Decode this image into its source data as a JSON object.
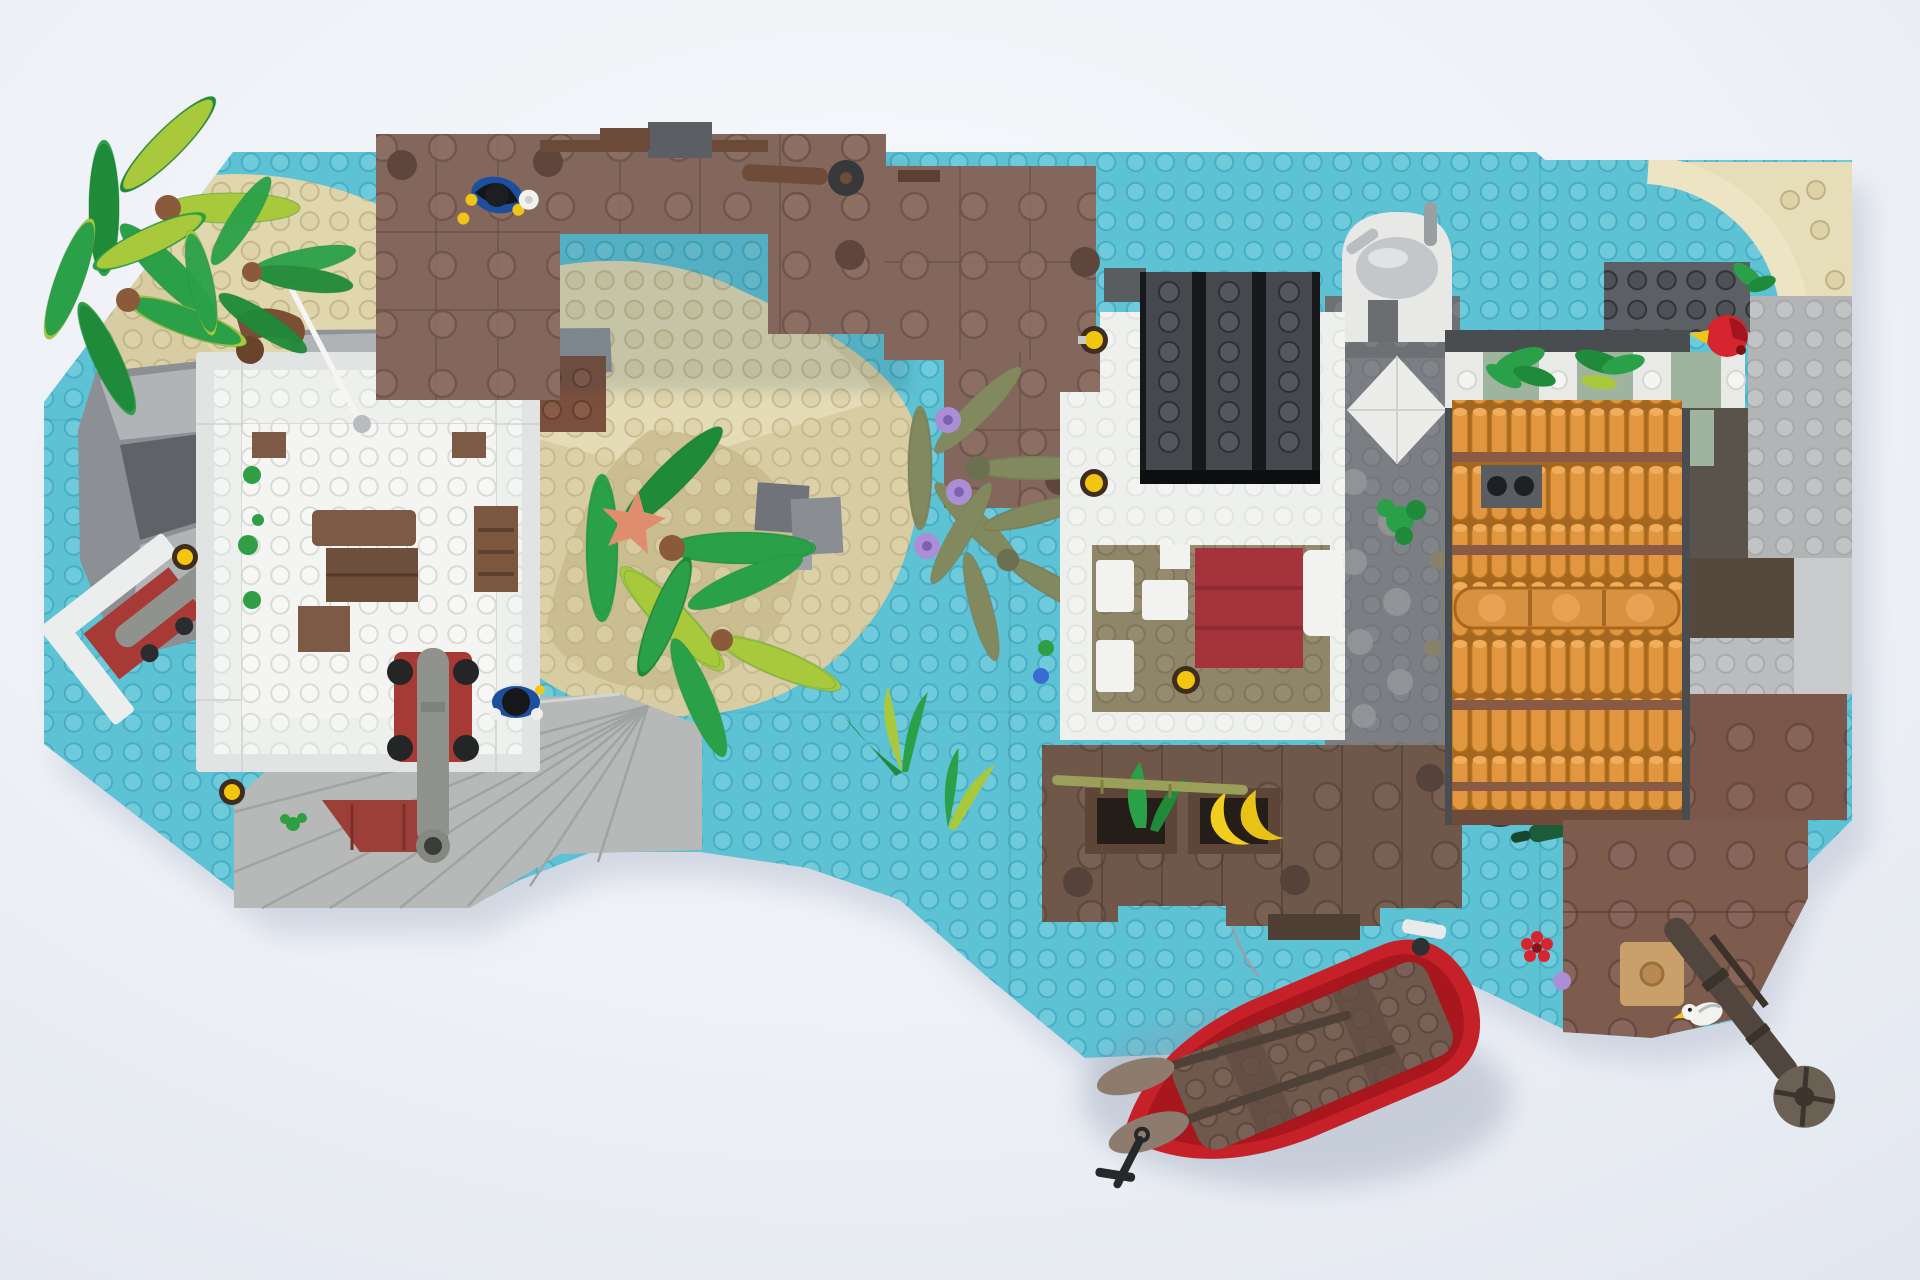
{
  "scene": {
    "title": "Top-down render of a LEGO pirate island harbor diorama",
    "type": "3D LEGO model render, no UI text visible",
    "view": "top-down aerial",
    "background": "soft white studio backdrop",
    "objects": [
      {
        "name": "baseplate",
        "description": "large medium-azure water baseplate with studs, irregular octagonal outline"
      },
      {
        "name": "sand-island-left",
        "description": "tan sand island at top-left with two palm trees"
      },
      {
        "name": "palm-trees-left",
        "description": "two palm canopies of bright green and lime fronds with brown trunk pieces"
      },
      {
        "name": "fort",
        "description": "square white-walled fort with open courtyard, brown furniture, ladder, cannon on red carriage pointing south, leaning white flag mast"
      },
      {
        "name": "fort-minifig",
        "description": "minifigure with black hair and blue jacket inside fort near cannon"
      },
      {
        "name": "gun-emplacement",
        "description": "small angled gun platform with white walls, dark-red base and gray cannon at island west shore"
      },
      {
        "name": "stone-stairs",
        "description": "fanned light-gray stair slabs descending at the island south edge"
      },
      {
        "name": "sand-mound-center",
        "description": "large round sand mound with gray rock bricks and a salmon starfish"
      },
      {
        "name": "north-dock",
        "description": "reddish-brown plank dock complex along the top edge with mounted cannon and a soldier minifig in blue coat, black tricorn, holding a white mug"
      },
      {
        "name": "center-palm",
        "description": "bright green and lime palm canopy south of the sand mound"
      },
      {
        "name": "olive-palm",
        "description": "fallen olive-green palm fronds in the water with three lavender flowers"
      },
      {
        "name": "tavern-building",
        "description": "white building with dark-gray corrugated ridged roof"
      },
      {
        "name": "bedroom",
        "description": "open-roof white room with dark-tan floor, dark-red bed and white pillow, yellow lantern"
      },
      {
        "name": "courtyard",
        "description": "gray stone path with white diamond tile and round paving stones, small green bush"
      },
      {
        "name": "well",
        "description": "white arched alcove with silver metal dome lid and pipe at the north side"
      },
      {
        "name": "tiled-roof-building",
        "description": "building roofed with orange terracotta barrel tiles, brown ridge strips and a gray chimney; striped white and sand-green wall band with green vines"
      },
      {
        "name": "parrot",
        "description": "red parrot with yellow beak perched on dark-gray wall at top-right"
      },
      {
        "name": "sand-dune-arc",
        "description": "cream quarter-circle sand dune at the top-right corner"
      },
      {
        "name": "market-dock",
        "description": "dark-brown plank dock with bamboo pole, two crates, green leaves and yellow bananas, green bottle and two spare wheels"
      },
      {
        "name": "south-east-dock",
        "description": "reddish-brown dock with tan table, wheeled cannon pointing off the edge, white seagull and dark sabre"
      },
      {
        "name": "rowboat",
        "description": "red rowboat with brown deck, two oars, silver stern fitting and black anchor, moored below the dock"
      },
      {
        "name": "flowers",
        "description": "three lavender flowers, one red and one purple flower near the SE dock, blue and green flowers at the market dock edge"
      },
      {
        "name": "lanterns",
        "description": "five yellow lantern/torch pieces around fort, stairs and buildings"
      }
    ],
    "counts": {
      "palm_canopies": 5,
      "lanterns": 5,
      "purple_flowers": 3,
      "minifigs": 2,
      "cannons": 4,
      "boats": 1
    }
  },
  "colors": {
    "background": "#edf0f6",
    "water": "#5ec2d5",
    "sand": "#d8cda2",
    "sandLight": "#e6ddb9",
    "sandCream": "#ece4c2",
    "rockGray": "#8c9095",
    "stairsGray": "#b6b9b8",
    "fortWall": "#e2e4e3",
    "fortParapet": "#eef0ee",
    "fortFloor": "#f4f5f2",
    "darkRedRoof": "#9c3f38",
    "topDock": "#84675c",
    "marketDock": "#6f5849",
    "rightDock": "#7d5c4e",
    "furnitureBrown": "#7c5a46",
    "roofBlack": "#17181a",
    "roofRidge": "#45484d",
    "roofOrangeBase": "#9a5f24",
    "tileOrange": "#e2963f",
    "ridgeBrown": "#8a5a46",
    "courtyard": "#7b7e82",
    "diamondWhite": "#ecedeb",
    "wallSandGreen": "#9fb49e",
    "floorTan": "#8f8569",
    "bedRed": "#a5333c",
    "pillowWhite": "#f2f3f1",
    "wellWhite": "#e8e9e7",
    "domeSilver": "#c3c7c9",
    "boatRed": "#c62128",
    "boatDeck": "#6f584c",
    "oarBlade": "#8d7c6e",
    "palmGreen": "#2aa148",
    "palmLime": "#a9c93c",
    "oliveGreen": "#83895f",
    "bananaYellow": "#f2cf1e",
    "lanternYellow": "#f4c50f",
    "purpleFlower": "#ab8fd6",
    "redFlower": "#d6252e",
    "blueFlower": "#3a6bd4",
    "greenFlower": "#2f9e44",
    "starfish": "#de8e6e",
    "parrotRed": "#d6252e",
    "cannonGray": "#8f928d",
    "carriageRed": "#a83a36",
    "minifigBlue": "#1d4f9e",
    "seagull": "#f2f3f0",
    "bottleGreen": "#1c5c38",
    "bambooOlive": "#9aa05a"
  }
}
